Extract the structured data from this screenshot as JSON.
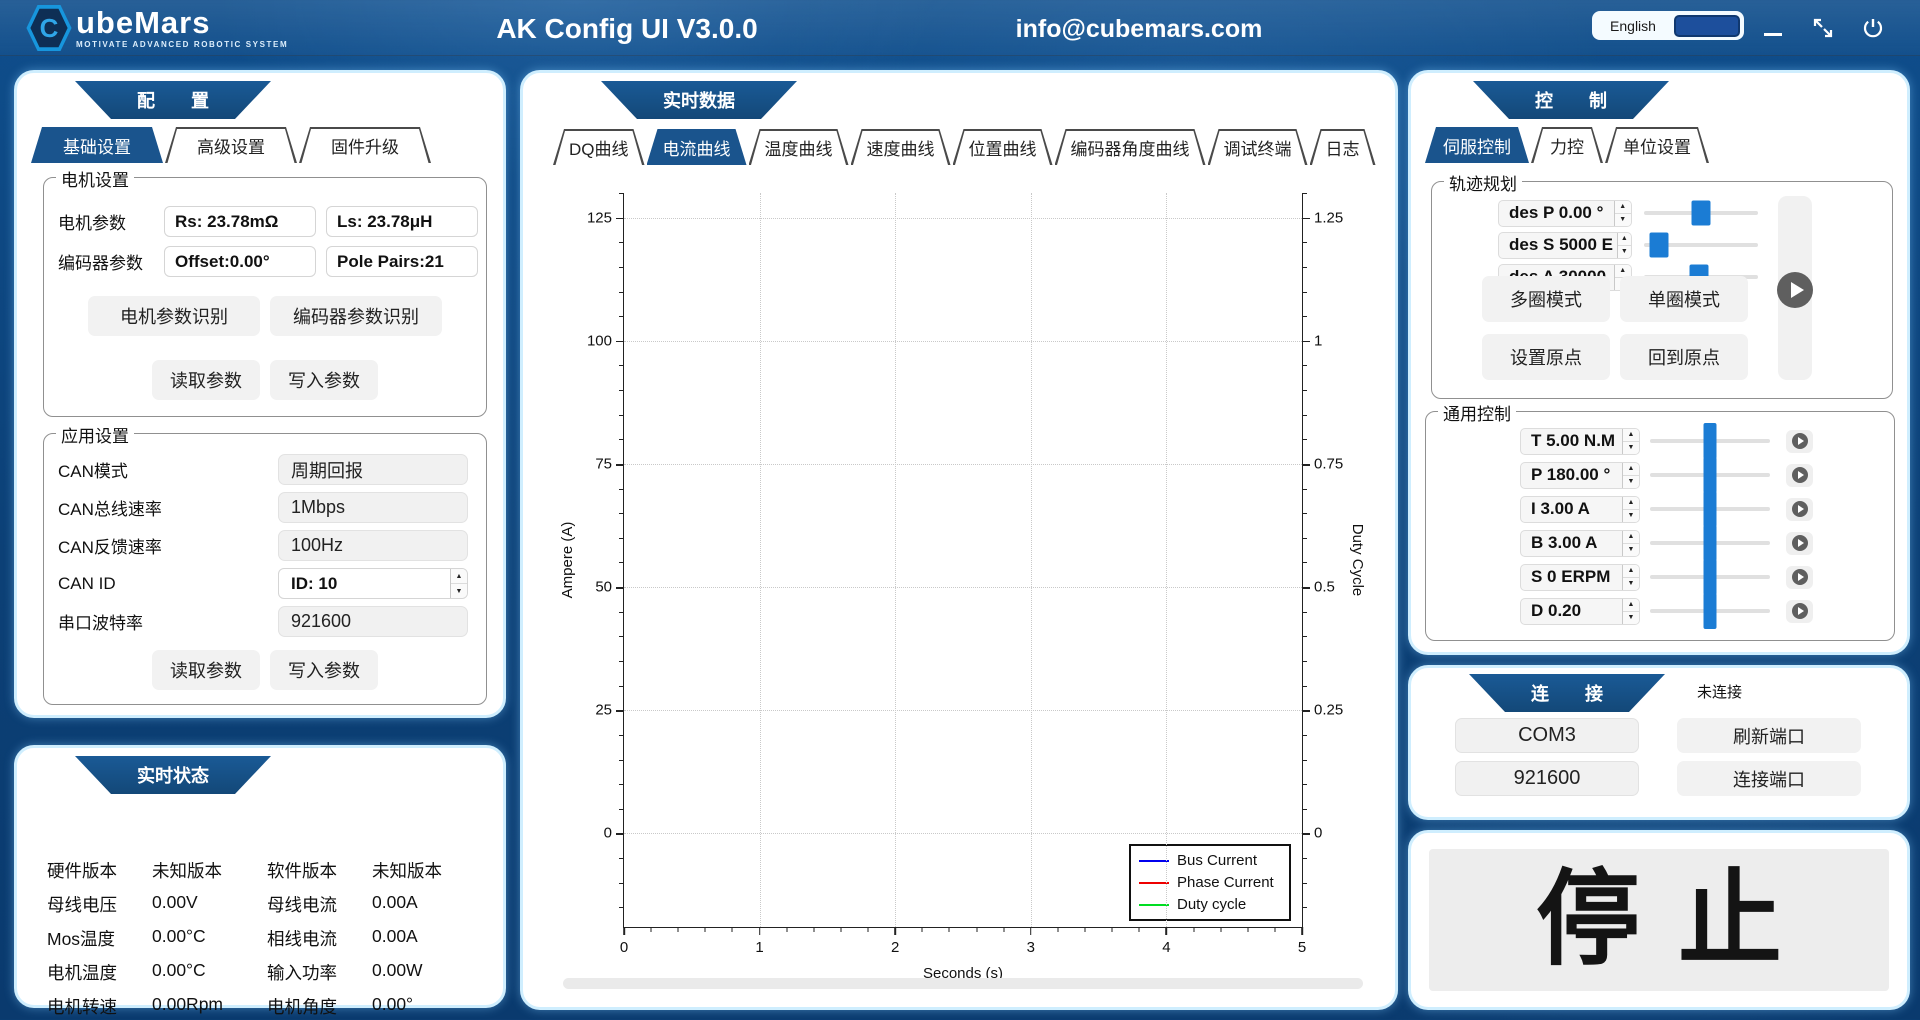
{
  "header": {
    "brand": {
      "letter": "C",
      "name": "ubeMars",
      "tagline": "MOTIVATE ADVANCED ROBOTIC SYSTEM"
    },
    "title": "AK Config UI V3.0.0",
    "email": "info@cubemars.com",
    "language_label": "English"
  },
  "config_panel": {
    "banner": "配　　置",
    "tabs": [
      {
        "label": "基础设置"
      },
      {
        "label": "高级设置"
      },
      {
        "label": "固件升级"
      }
    ],
    "motor_group": {
      "title": "电机设置",
      "motor_param_label": "电机参数",
      "rs": "Rs: 23.78mΩ",
      "ls": "Ls: 23.78μH",
      "encoder_param_label": "编码器参数",
      "offset": "Offset:0.00°",
      "pole_pairs": "Pole Pairs:21",
      "btn_motor_identify": "电机参数识别",
      "btn_encoder_identify": "编码器参数识别",
      "btn_read": "读取参数",
      "btn_write": "写入参数"
    },
    "app_group": {
      "title": "应用设置",
      "rows": [
        {
          "label": "CAN模式",
          "value": "周期回报"
        },
        {
          "label": "CAN总线速率",
          "value": "1Mbps"
        },
        {
          "label": "CAN反馈速率",
          "value": "100Hz"
        },
        {
          "label": "CAN ID",
          "value": "ID: 10"
        },
        {
          "label": "串口波特率",
          "value": "921600"
        }
      ],
      "btn_read": "读取参数",
      "btn_write": "写入参数"
    }
  },
  "status_panel": {
    "banner": "实时状态",
    "items": [
      {
        "label": "硬件版本",
        "value": "未知版本"
      },
      {
        "label": "软件版本",
        "value": "未知版本"
      },
      {
        "label": "母线电压",
        "value": "0.00V"
      },
      {
        "label": "母线电流",
        "value": "0.00A"
      },
      {
        "label": "Mos温度",
        "value": "0.00°C"
      },
      {
        "label": "相线电流",
        "value": "0.00A"
      },
      {
        "label": "电机温度",
        "value": "0.00°C"
      },
      {
        "label": "输入功率",
        "value": "0.00W"
      },
      {
        "label": "电机转速",
        "value": "0.00Rpm"
      },
      {
        "label": "电机角度",
        "value": "0.00°"
      },
      {
        "label": "当前模式",
        "value": "未知模式"
      },
      {
        "label": "当前故障",
        "value": "无故障"
      }
    ]
  },
  "data_panel": {
    "banner": "实时数据",
    "tabs": [
      {
        "label": "DQ曲线"
      },
      {
        "label": "电流曲线"
      },
      {
        "label": "温度曲线"
      },
      {
        "label": "速度曲线"
      },
      {
        "label": "位置曲线"
      },
      {
        "label": "编码器角度曲线"
      },
      {
        "label": "调试终端"
      },
      {
        "label": "日志"
      }
    ]
  },
  "chart_data": {
    "type": "line",
    "title": "",
    "xlabel": "Seconds (s)",
    "ylabel_left": "Ampere (A)",
    "ylabel_right": "Duty Cycle",
    "xlim": [
      0,
      5
    ],
    "ylim_left": [
      -19,
      130
    ],
    "ylim_right": [
      -0.19,
      1.3
    ],
    "x_ticks": [
      0,
      1,
      2,
      3,
      4,
      5
    ],
    "y_ticks_left": [
      0,
      25,
      50,
      75,
      100,
      125
    ],
    "y_ticks_right": [
      "0",
      "0.25",
      "0.5",
      "0.75",
      "1",
      "1.25"
    ],
    "x_minor_step": 0.2,
    "y_minor_step": 5,
    "grid": "dotted",
    "legend_position": "bottom-right",
    "series": [
      {
        "name": "Bus Current",
        "color": "#0000ee",
        "x": [],
        "y": []
      },
      {
        "name": "Phase Current",
        "color": "#ee0000",
        "x": [],
        "y": []
      },
      {
        "name": "Duty cycle",
        "color": "#00dd22",
        "x": [],
        "y": []
      }
    ]
  },
  "control_panel": {
    "banner": "控　　制",
    "tabs": [
      {
        "label": "伺服控制"
      },
      {
        "label": "力控"
      },
      {
        "label": "单位设置"
      }
    ],
    "trajectory_group": {
      "title": "轨迹规划",
      "rows": [
        {
          "value": "des P 0.00 °",
          "slider_pct": 50
        },
        {
          "value": "des S 5000 E",
          "slider_pct": 13
        },
        {
          "value": "des A 30000",
          "slider_pct": 48
        }
      ],
      "btn_multi_turn": "多圈模式",
      "btn_single_turn": "单圈模式",
      "btn_set_origin": "设置原点",
      "btn_back_origin": "回到原点"
    },
    "general_group": {
      "title": "通用控制",
      "rows": [
        {
          "value": "T 5.00 N.M",
          "slider_pct": 50
        },
        {
          "value": "P 180.00 °",
          "slider_pct": 50
        },
        {
          "value": "I 3.00 A",
          "slider_pct": 50
        },
        {
          "value": "B 3.00 A",
          "slider_pct": 50
        },
        {
          "value": "S 0 ERPM",
          "slider_pct": 50
        },
        {
          "value": "D 0.20",
          "slider_pct": 50
        }
      ]
    }
  },
  "connection_panel": {
    "banner": "连　　接",
    "status": "未连接",
    "port": "COM3",
    "baud": "921600",
    "btn_refresh": "刷新端口",
    "btn_connect": "连接端口"
  },
  "stop_panel": {
    "label": "停止"
  }
}
